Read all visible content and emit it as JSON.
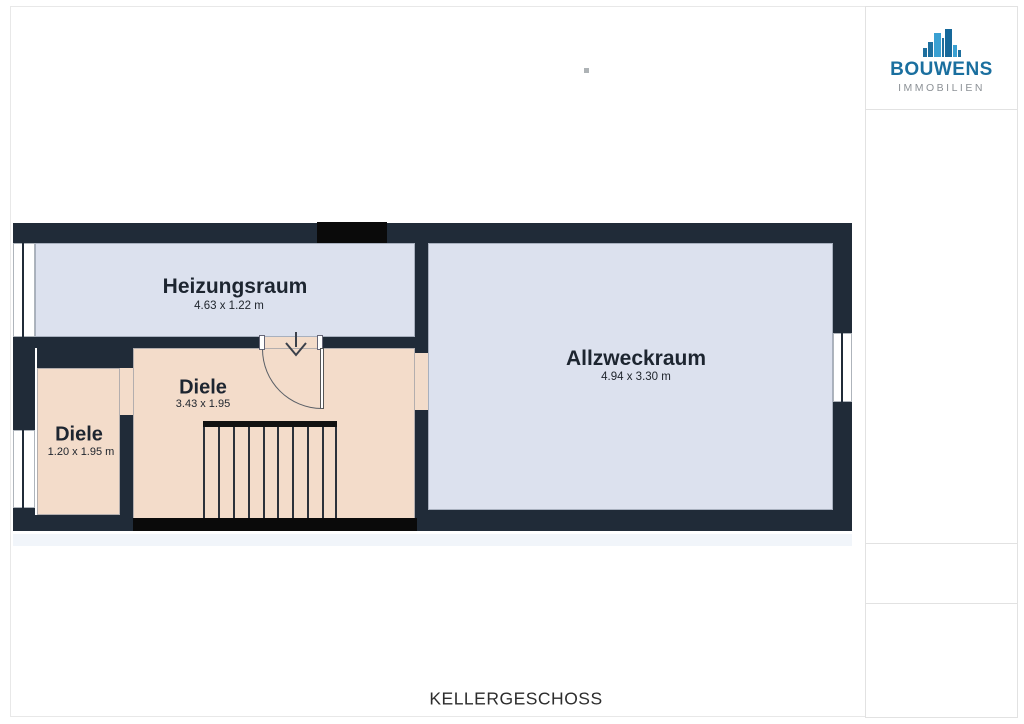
{
  "page": {
    "floor_title": "KELLERGESCHOSS"
  },
  "logo": {
    "brand": "BOUWENS",
    "subtitle": "IMMOBILIEN",
    "brand_color": "#1a6f9f",
    "subtitle_color": "#8c9196",
    "icon": "buildings-skyline-icon",
    "icon_colors": [
      "#1e6f9e",
      "#3aa0d2",
      "#16689a"
    ]
  },
  "floor_plan": {
    "rooms": [
      {
        "name": "Heizungsraum",
        "dimensions": "4.63 x 1.22 m"
      },
      {
        "name": "Allzweckraum",
        "dimensions": "4.94 x 3.30 m"
      },
      {
        "name": "Diele",
        "dimensions": "3.43 x 1.95"
      },
      {
        "name": "Diele",
        "dimensions": "1.20 x 1.95 m"
      }
    ],
    "features": [
      "stairs",
      "swing-door",
      "3 windows",
      "top door opening"
    ],
    "colors": {
      "wall": "#202b38",
      "room_blue": "#dce1ee",
      "room_peach": "#f3dcca",
      "accent_black": "#0a0a0a"
    }
  }
}
